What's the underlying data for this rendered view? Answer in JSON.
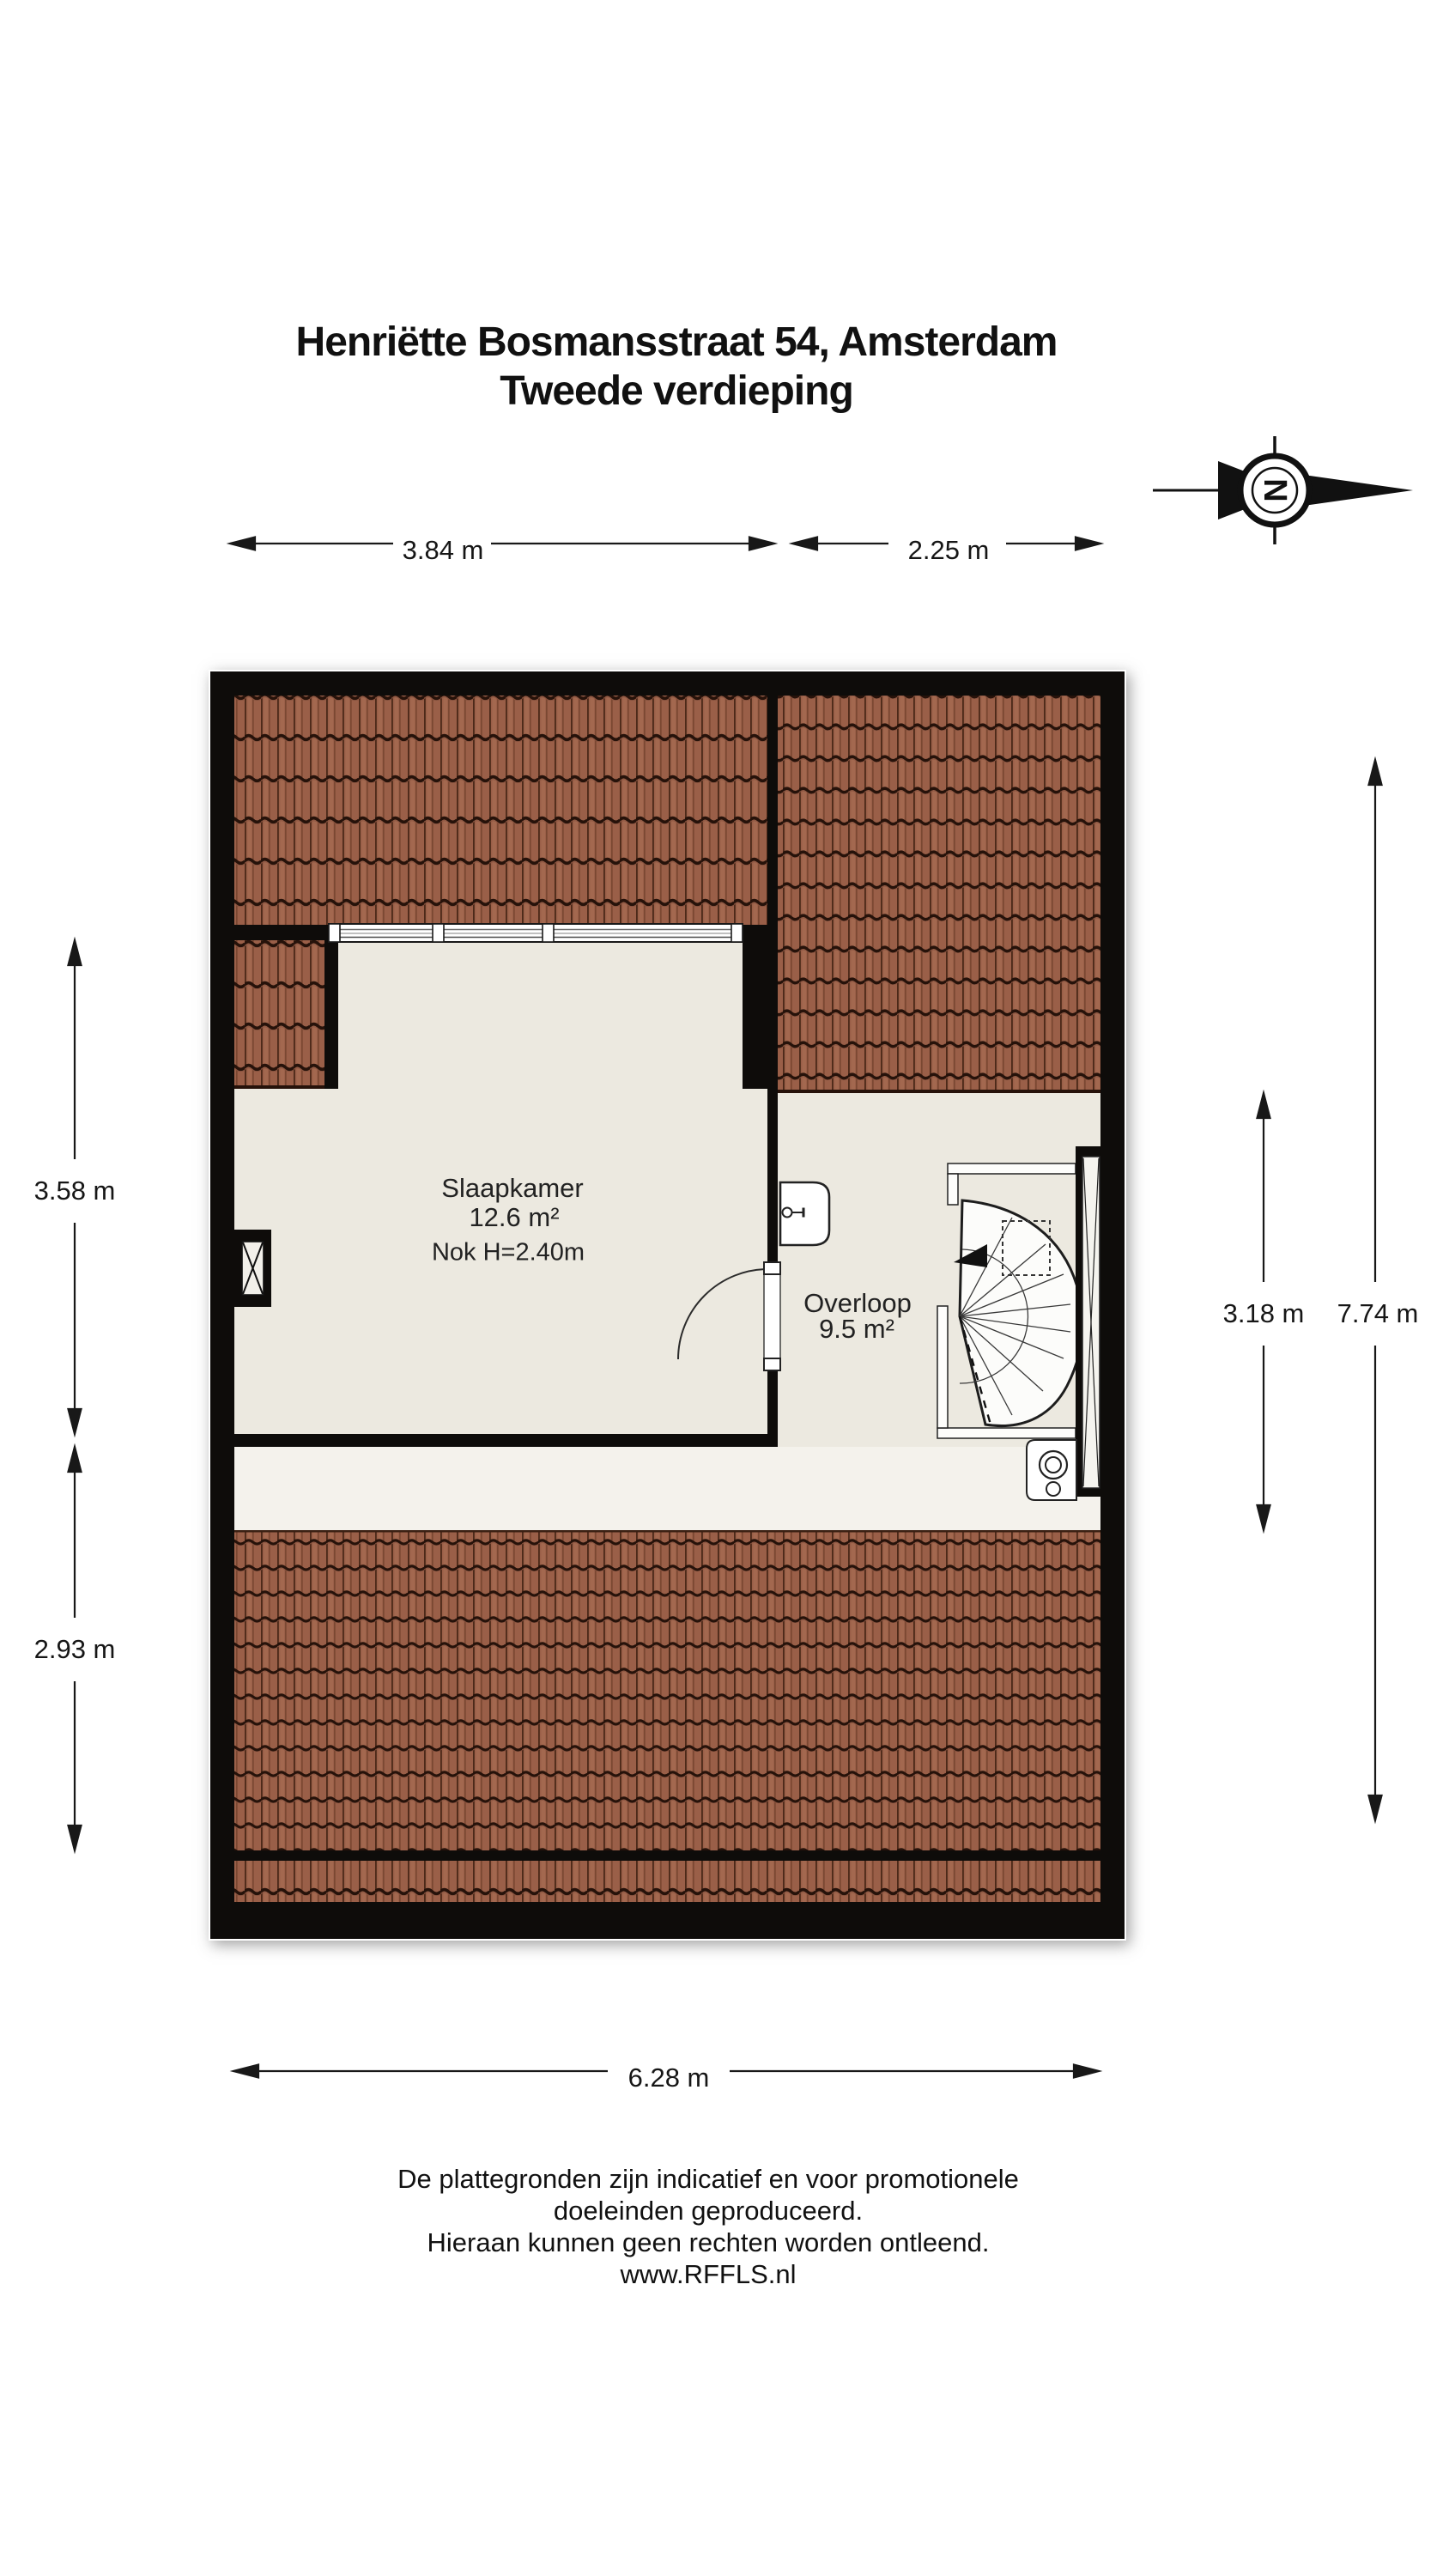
{
  "title": {
    "line1": "Henriëtte Bosmansstraat 54, Amsterdam",
    "line2": "Tweede verdieping"
  },
  "compass": {
    "letter": "N"
  },
  "rooms": {
    "slaapkamer": {
      "name": "Slaapkamer",
      "area": "12.6 m²",
      "note": "Nok H=2.40m"
    },
    "overloop": {
      "name": "Overloop",
      "area": "9.5 m²"
    }
  },
  "dimensions": {
    "top_left": {
      "label": "3.84 m"
    },
    "top_right": {
      "label": "2.25 m"
    },
    "left_upper": {
      "label": "3.58 m"
    },
    "left_lower": {
      "label": "2.93 m"
    },
    "right_inner": {
      "label": "3.18 m"
    },
    "right_outer": {
      "label": "7.74 m"
    },
    "bottom": {
      "label": "6.28 m"
    }
  },
  "footer": {
    "line1": "De plattegronden zijn indicatief en voor promotionele doeleinden geproduceerd.",
    "line2": "Hieraan kunnen geen rechten worden ontleend.",
    "line3": "www.RFFLS.nl"
  },
  "colors": {
    "wall": "#0e0c0a",
    "floor": "#ece9e0",
    "floor_light": "#f4f2ec",
    "roof": "#9a5f48",
    "roof_shadow": "#26120a"
  }
}
